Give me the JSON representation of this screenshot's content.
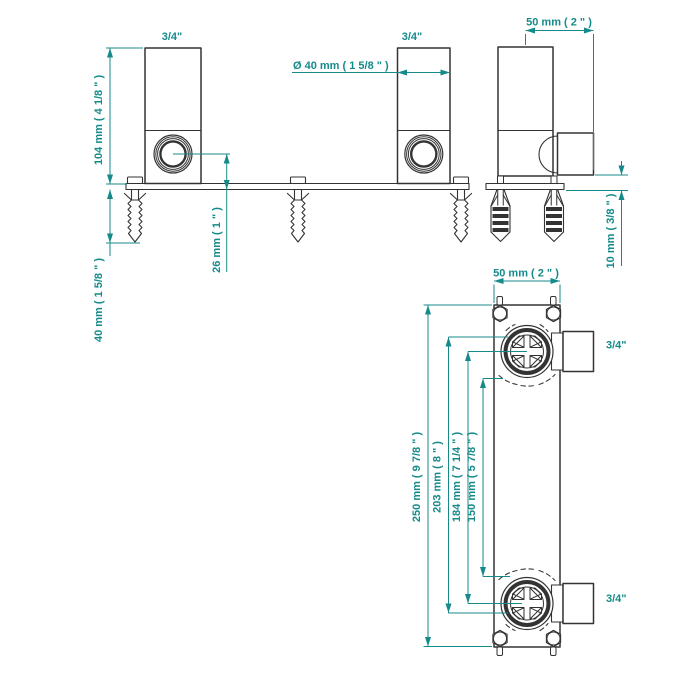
{
  "drawing": {
    "front": {
      "left_pipe_label": "3/4\"",
      "right_pipe_label": "3/4\"",
      "diameter_label": "Ø 40 mm ( 1 5/8 \" )",
      "height_label": "104 mm ( 4 1/8 \" )",
      "anchor_length_label": "40 mm ( 1 5/8 \" )",
      "center_offset_label": "26 mm ( 1 \" )"
    },
    "side": {
      "depth_label": "50 mm ( 2 \" )",
      "wall_gap_label": "10 mm ( 3/8 \" )"
    },
    "plan": {
      "width_label": "50 mm ( 2 \" )",
      "overall_length_label": "250 mm ( 9 7/8 \" )",
      "outer_length_label": "203 mm ( 8 \" )",
      "center_distance_label": "184 mm ( 7 1/4 \" )",
      "inner_length_label": "150 mm ( 5 7/8 \" )",
      "top_outlet_label": "3/4\"",
      "bottom_outlet_label": "3/4\""
    },
    "colors": {
      "dimension": "#168a8a",
      "outline": "#333333"
    }
  }
}
